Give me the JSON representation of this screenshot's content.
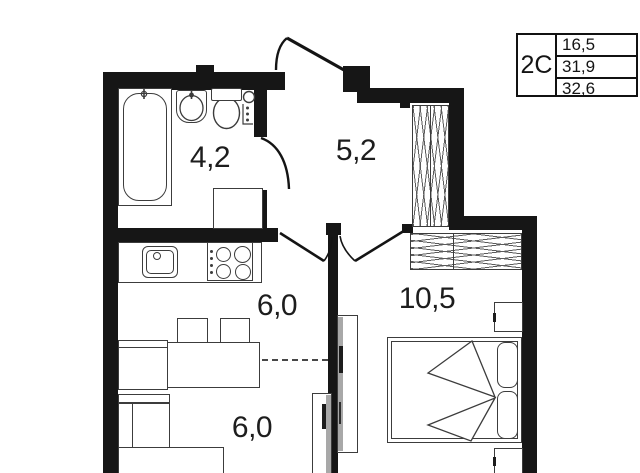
{
  "plan": {
    "title": "apartment floor plan",
    "info_table": {
      "type_label": "2С",
      "values": [
        "16,5",
        "31,9",
        "32,6"
      ]
    },
    "rooms": {
      "bathroom": {
        "name": "bathroom",
        "area": "4,2"
      },
      "hallway": {
        "name": "hallway",
        "area": "5,2"
      },
      "kitchen": {
        "name": "kitchen",
        "area": "6,0"
      },
      "living": {
        "name": "living area",
        "area": "6,0"
      },
      "bedroom": {
        "name": "bedroom",
        "area": "10,5"
      }
    },
    "fixtures": [
      "bathtub",
      "bath-sink",
      "toilet",
      "water-meter",
      "washing-machine",
      "kitchen-sink",
      "stove",
      "dining-table",
      "chairs",
      "kitchen-cabinet",
      "corner-sofa",
      "double-bed",
      "pillows",
      "blanket",
      "nightstands",
      "hallway-wardrobe",
      "bedroom-wardrobe",
      "sliding-panels",
      "entrance-door",
      "bathroom-door",
      "kitchen-door",
      "bedroom-door"
    ],
    "colors": {
      "wall": "#161616",
      "line": "#3c3c3c",
      "label": "#1d1d1d",
      "bg": "#ffffff"
    }
  }
}
